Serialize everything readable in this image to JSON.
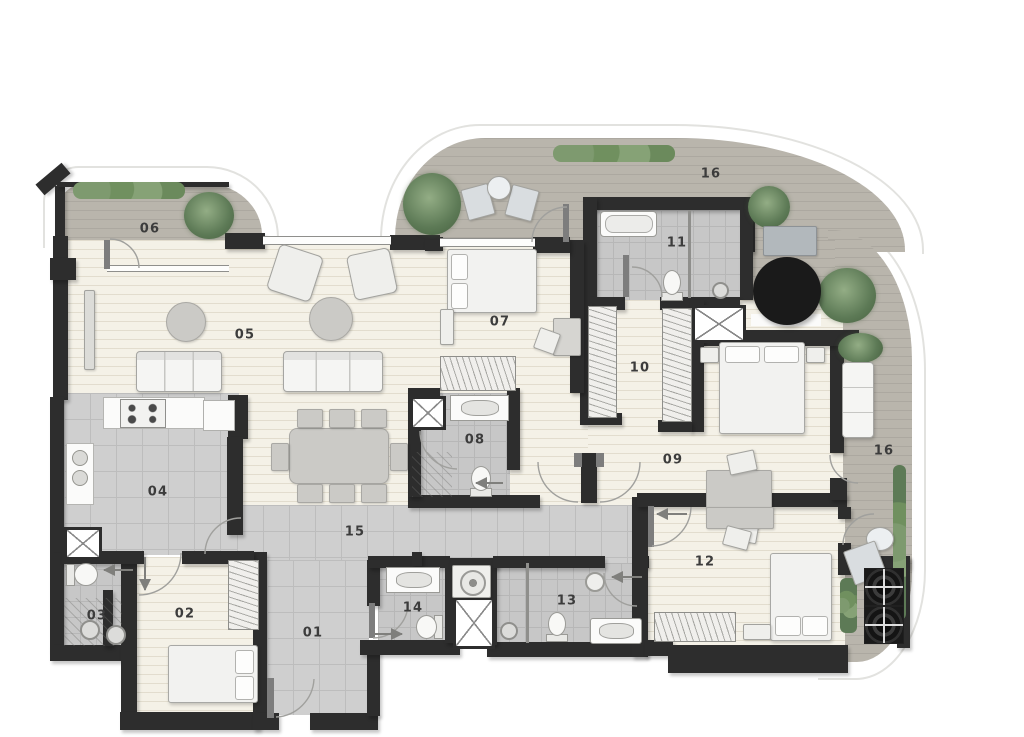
{
  "plan": {
    "type": "apartment-floor-plan",
    "colors": {
      "wall": "#2d2d2d",
      "terrace_deck": "#b9b5ac",
      "wood_floor": "#f4f1e7",
      "tile_floor": "#cfcfcf",
      "bath_tile": "#c7c7c7",
      "greenery": "#5d7a56"
    },
    "rooms": [
      {
        "id": "room-01",
        "label": "01"
      },
      {
        "id": "room-02",
        "label": "02"
      },
      {
        "id": "room-03",
        "label": "03"
      },
      {
        "id": "room-04",
        "label": "04"
      },
      {
        "id": "room-05",
        "label": "05"
      },
      {
        "id": "room-06",
        "label": "06"
      },
      {
        "id": "room-07",
        "label": "07"
      },
      {
        "id": "room-08",
        "label": "08"
      },
      {
        "id": "room-09",
        "label": "09"
      },
      {
        "id": "room-10",
        "label": "10"
      },
      {
        "id": "room-11",
        "label": "11"
      },
      {
        "id": "room-12",
        "label": "12"
      },
      {
        "id": "room-13",
        "label": "13"
      },
      {
        "id": "room-14",
        "label": "14"
      },
      {
        "id": "room-15",
        "label": "15"
      },
      {
        "id": "room-16-top",
        "label": "16"
      },
      {
        "id": "room-16-right",
        "label": "16"
      }
    ]
  }
}
